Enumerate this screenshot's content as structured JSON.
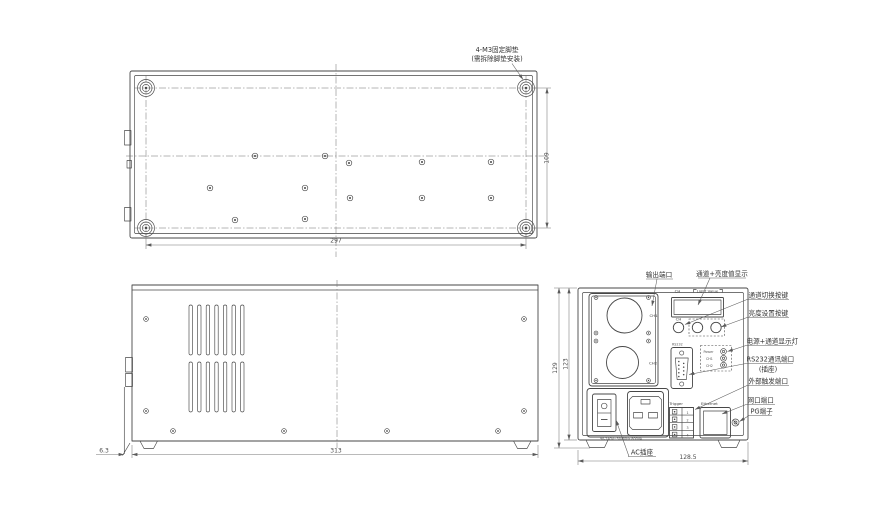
{
  "bottom_view": {
    "foot_note_line1": "4-M3固定脚垫",
    "foot_note_line2": "(需拆除脚垫安装)",
    "dim_width": "297",
    "dim_depth": "109"
  },
  "side_view": {
    "dim_width": "313",
    "dim_foot_offset": "6.3"
  },
  "rear_view": {
    "dim_width": "128.5",
    "dim_height_outer": "129",
    "dim_height_inner": "123",
    "callouts": {
      "output_port": "输出端口",
      "display": "通道+亮度值显示",
      "channel_switch_key": "通道切换按键",
      "brightness_set_key": "亮度设置按键",
      "power_channel_leds": "电源+通道显示灯",
      "rs232_port": "RS232通讯端口",
      "rs232_port_sub": "(插座)",
      "external_trigger_port": "外部触发端口",
      "lan_port": "网口端口",
      "pg_terminal": "PG端子",
      "ac_socket": "AC插座"
    },
    "panel": {
      "display_ch": "CH",
      "display_light_value": "Light Value",
      "btn_ch": "CH",
      "out_ch1": "CH1",
      "out_ch2": "CH2",
      "rs232": "RS232",
      "led_power": "Power",
      "led_ch1": "CH1",
      "led_ch2": "CH2",
      "trigger": "Trigger",
      "trigger_pins": [
        "1",
        "2",
        "3",
        "4"
      ],
      "ethernet": "Ethernet",
      "rating": "90-240V~50/60Hz 800VA"
    }
  }
}
